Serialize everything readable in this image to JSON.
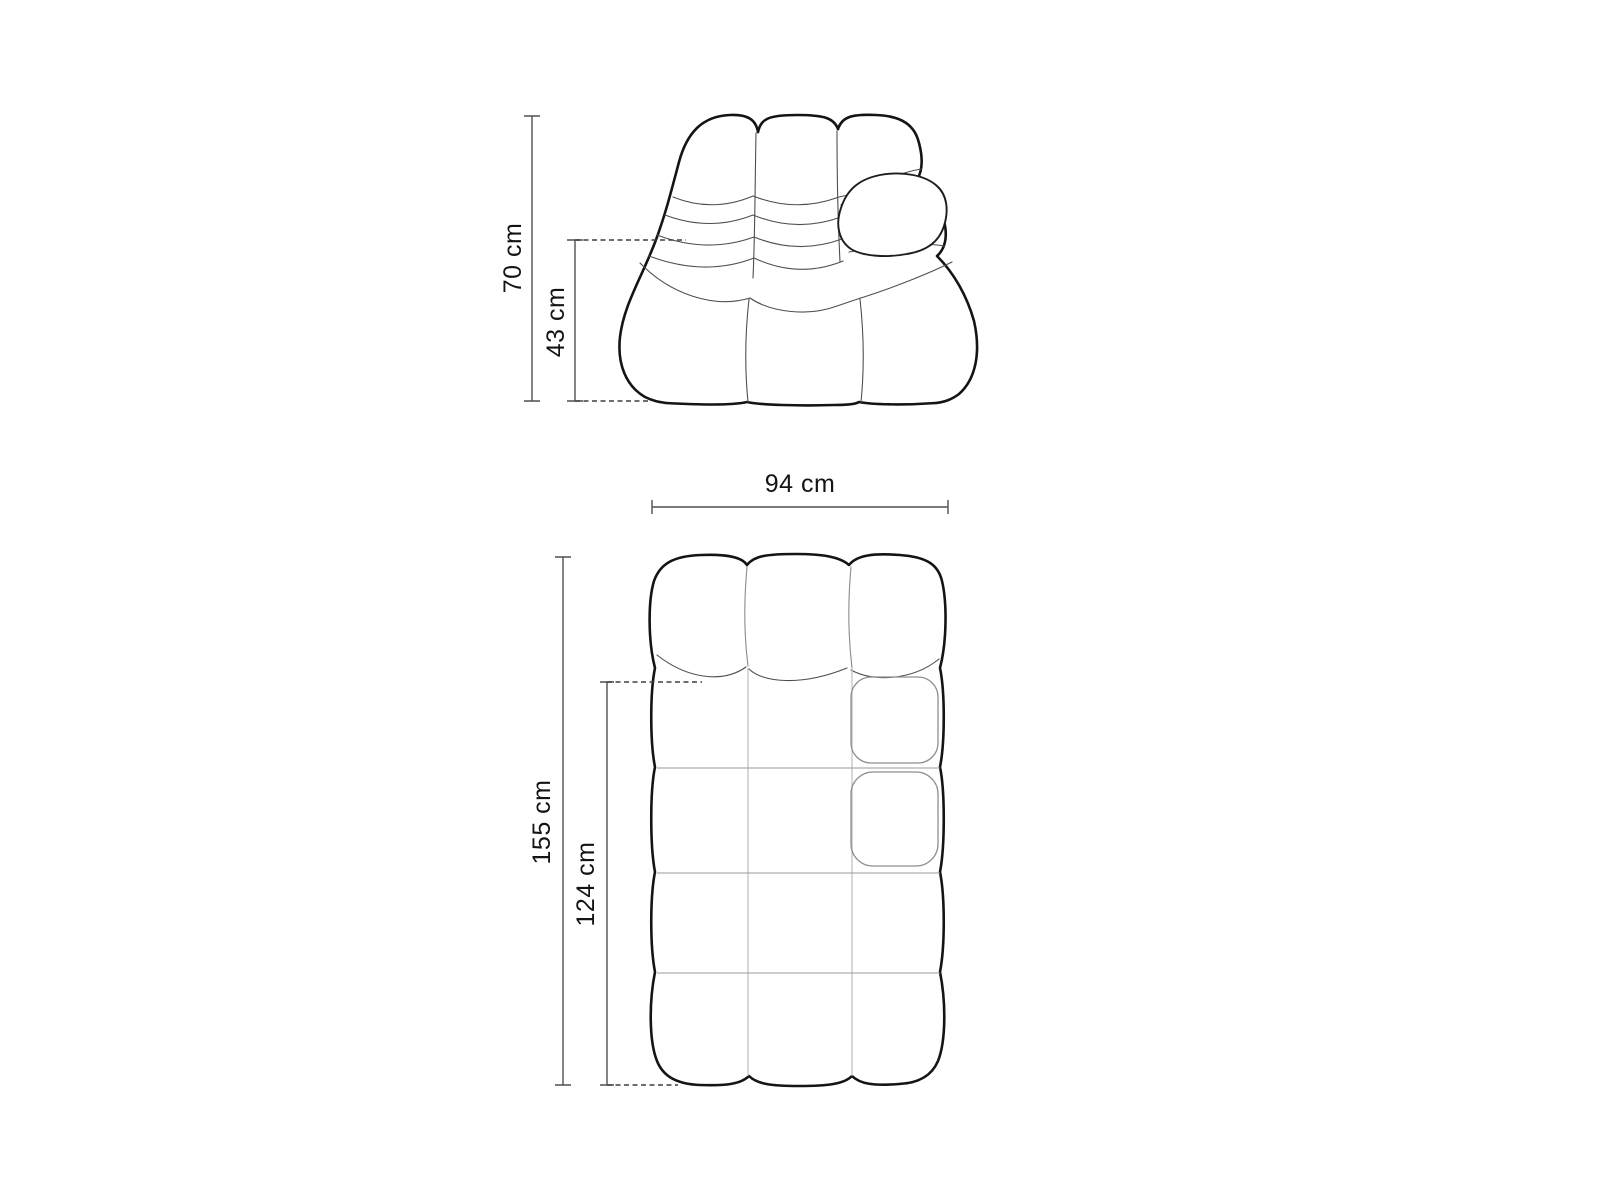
{
  "colors": {
    "background": "#ffffff",
    "outline": "#141414",
    "seam": "#4f4f4f",
    "grid_line": "#bdbdbd",
    "row_line": "#9a9a9a",
    "dimension_line": "#4f4f4f",
    "label_text": "#141414"
  },
  "front_view": {
    "height_label": "70 cm",
    "seat_height_label": "43 cm"
  },
  "plan_view": {
    "width_label": "94 cm",
    "depth_label": "155 cm",
    "seat_depth_label": "124 cm"
  },
  "dimensions_data": {
    "unit": "cm",
    "overall_height": 70,
    "seat_height": 43,
    "width": 94,
    "depth": 155,
    "seat_depth": 124
  }
}
